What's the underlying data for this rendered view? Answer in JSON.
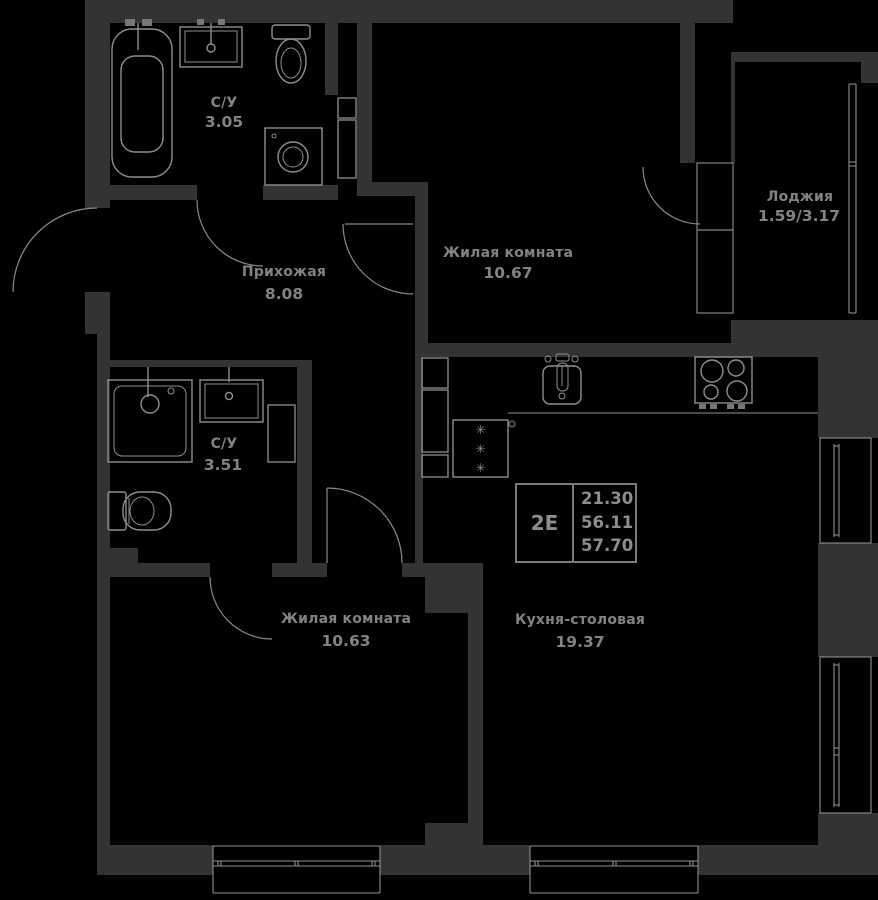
{
  "plan": {
    "unit": {
      "type": "2Е",
      "areas": [
        "21.30",
        "56.11",
        "57.70"
      ]
    },
    "rooms": [
      {
        "name": "С/У",
        "area": "3.05"
      },
      {
        "name": "Прихожая",
        "area": "8.08"
      },
      {
        "name": "Жилая комната",
        "area": "10.67"
      },
      {
        "name": "Лоджия",
        "area": "1.59/3.17"
      },
      {
        "name": "С/У",
        "area": "3.51"
      },
      {
        "name": "Жилая комната",
        "area": "10.63"
      },
      {
        "name": "Кухня-столовая",
        "area": "19.37"
      }
    ],
    "icons": {
      "snowflake": "✳"
    },
    "colors": {
      "background": "#000000",
      "wall": "#333333",
      "line": "#8f8f8f",
      "text": "#828282"
    }
  }
}
